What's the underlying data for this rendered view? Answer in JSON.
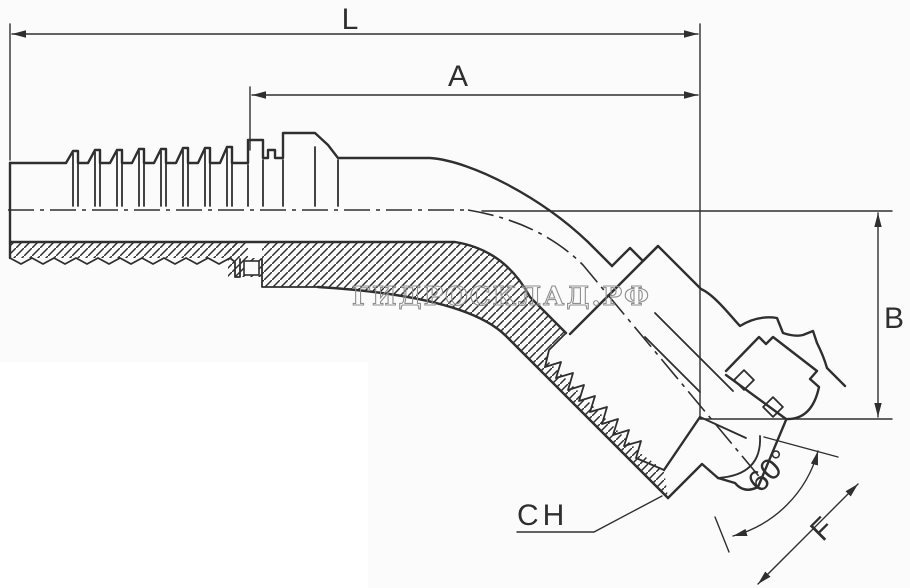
{
  "drawing": {
    "type": "technical-drawing",
    "subject": "45-degree elbow hydraulic hose fitting, half-section view",
    "watermark": {
      "text": "ГИДРОСКЛАД.РФ"
    },
    "dimensions": {
      "overall_length": {
        "label": "L"
      },
      "cutoff_length": {
        "label": "A"
      },
      "drop_height": {
        "label": "B"
      },
      "wrench_size": {
        "label": "CH"
      },
      "cone_angle": {
        "label": "60°"
      },
      "thread_size": {
        "label": "F"
      }
    },
    "colors": {
      "line": "#2f2f2f",
      "watermark": "#8f8f8f",
      "background": "#fbfbfb",
      "panel": "#ffffff"
    }
  }
}
